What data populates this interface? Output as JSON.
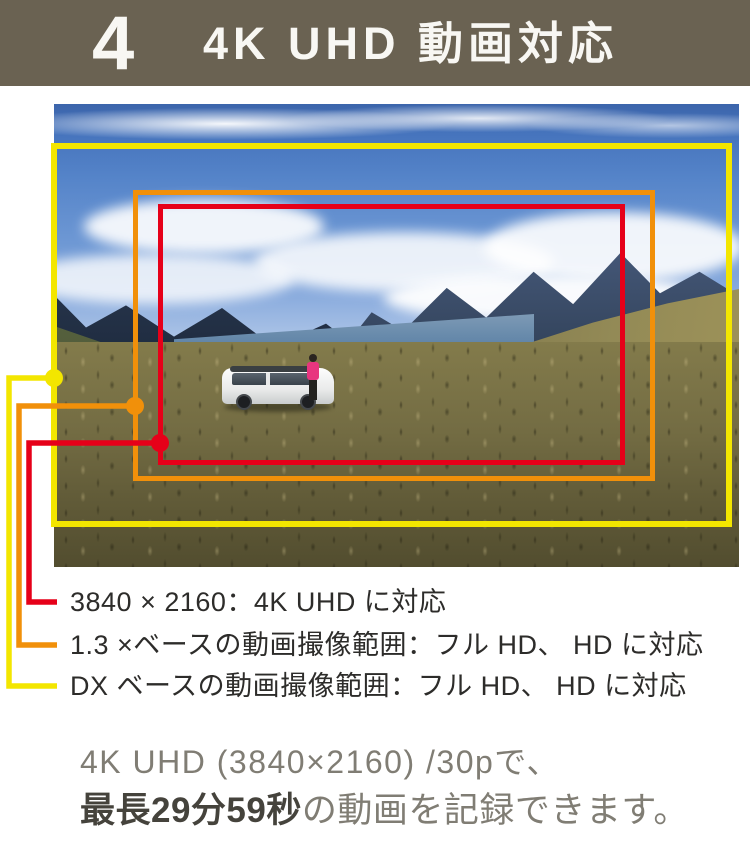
{
  "header": {
    "number": "4",
    "title": "4K UHD 動画対応"
  },
  "colors": {
    "header_bg": "#6a6252",
    "frame_yellow": "#f3e600",
    "frame_orange": "#f1900a",
    "frame_red": "#e60019",
    "legend_text": "#2d2c2a",
    "footer_gray": "#807d74",
    "footer_emphasis": "#45433c"
  },
  "legend": {
    "items": [
      {
        "id": "4k-uhd",
        "color": "#e60019",
        "label": "3840 × 2160：4K UHD に対応"
      },
      {
        "id": "1_3x-base",
        "color": "#f1900a",
        "label": "1.3 ×ベースの動画撮像範囲：フル HD、 HD に対応"
      },
      {
        "id": "dx-base",
        "color": "#f3e600",
        "label": "DX ベースの動画撮像範囲：フル HD、 HD に対応"
      }
    ]
  },
  "footer": {
    "line1": "4K UHD (3840×2160) /30pで、",
    "line2_bold": "最長29分59秒",
    "line2_rest": "の動画を記録できます。"
  }
}
